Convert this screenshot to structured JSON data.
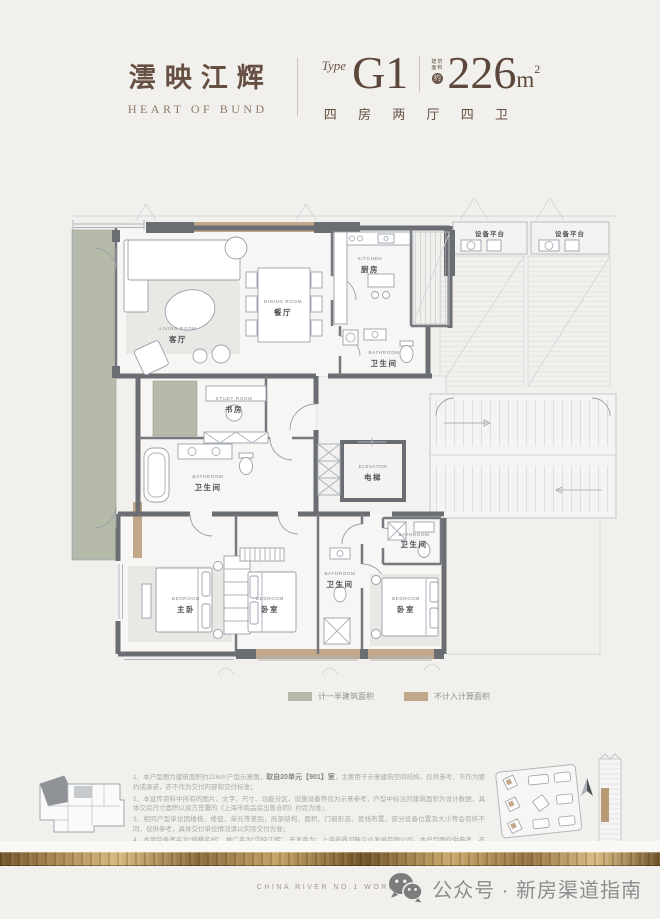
{
  "header": {
    "project_name_cn": "澐映江辉",
    "project_name_en": "HEART OF BUND",
    "type_label": "Type",
    "type_value": "G1",
    "area_note_line1": "建筑",
    "area_note_line2": "面积",
    "area_circle": "约",
    "area_value": "226",
    "area_unit": "m",
    "area_sup": "2",
    "layout_desc": "四 房 两 厅 四 卫"
  },
  "floorplan": {
    "rooms": {
      "living": {
        "en": "LIVING ROOM",
        "cn": "客厅"
      },
      "dining": {
        "en": "DINING ROOM",
        "cn": "餐厅"
      },
      "kitchen": {
        "en": "KITCHEN",
        "cn": "厨房"
      },
      "bath1": {
        "en": "BATHROOM",
        "cn": "卫生间"
      },
      "study": {
        "en": "STUDY ROOM",
        "cn": "书房"
      },
      "bath2": {
        "en": "BATHROOM",
        "cn": "卫生间"
      },
      "elevator": {
        "en": "ELEVATOR",
        "cn": "电梯"
      },
      "master": {
        "en": "BEDROOM",
        "cn": "主卧"
      },
      "bed2": {
        "en": "BEDROOM",
        "cn": "卧室"
      },
      "bath3": {
        "en": "BATHROOM",
        "cn": "卫生间"
      },
      "bath4": {
        "en": "BATHROOM",
        "cn": "卫生间"
      },
      "bed3": {
        "en": "BEDROOM",
        "cn": "卧室"
      },
      "equip1": {
        "cn": "设备平台"
      },
      "equip2": {
        "cn": "设备平台"
      }
    },
    "colors": {
      "wall": "#6a6d71",
      "half_area": "#b6baa8",
      "excluded_area": "#c2a88a"
    }
  },
  "legend": {
    "items": [
      {
        "label": "计一半建筑面积",
        "color": "#b6baa8"
      },
      {
        "label": "不计入计算面积",
        "color": "#c2a88a"
      }
    ]
  },
  "notes": {
    "n1a": "1、本户型图为建筑面积约226m²户型示意图，",
    "n1b": "取自20单元【901】室",
    "n1c": "，主要用于示意建筑空间结构，仅供参考，不作为要约或承诺，亦不作为交付内容和交付标准；",
    "n2": "2、本宣传资料中所有的图片、文字、尺寸、功能分区、设施设备等仅为示意参考，户型中标注的建筑面积为设计数据，具体交房尺寸面积以双方签署的《上海市商品房出售合同》约定为准；",
    "n3": "3、相同户型单位因楼栋、楼层、单元等差别，局部结构、面积、门窗形态、管线布置、部分设备位置及大小等会有所不同，仅供参考，具体交付单位情况请以实际交付为准；",
    "n4": "4、本项目备案名为“璟耀名邸”，推广名为“澐映江辉”，开发商为：上海新界河畔企业发展有限公司。本户型图仅供参考，不作为要约或承诺，相关内容不排除因政府相关规划、规定及开发商未能控制的原因而发生变化。本公司保留对宣传资料更改的权利，敬请留意最新资料。本户型图制作时间为2025年10月。"
  },
  "footer": {
    "works_label": "CHINA RIVER NO.1 WORKS",
    "wechat_label": "公众号 · 新房渠道指南"
  }
}
